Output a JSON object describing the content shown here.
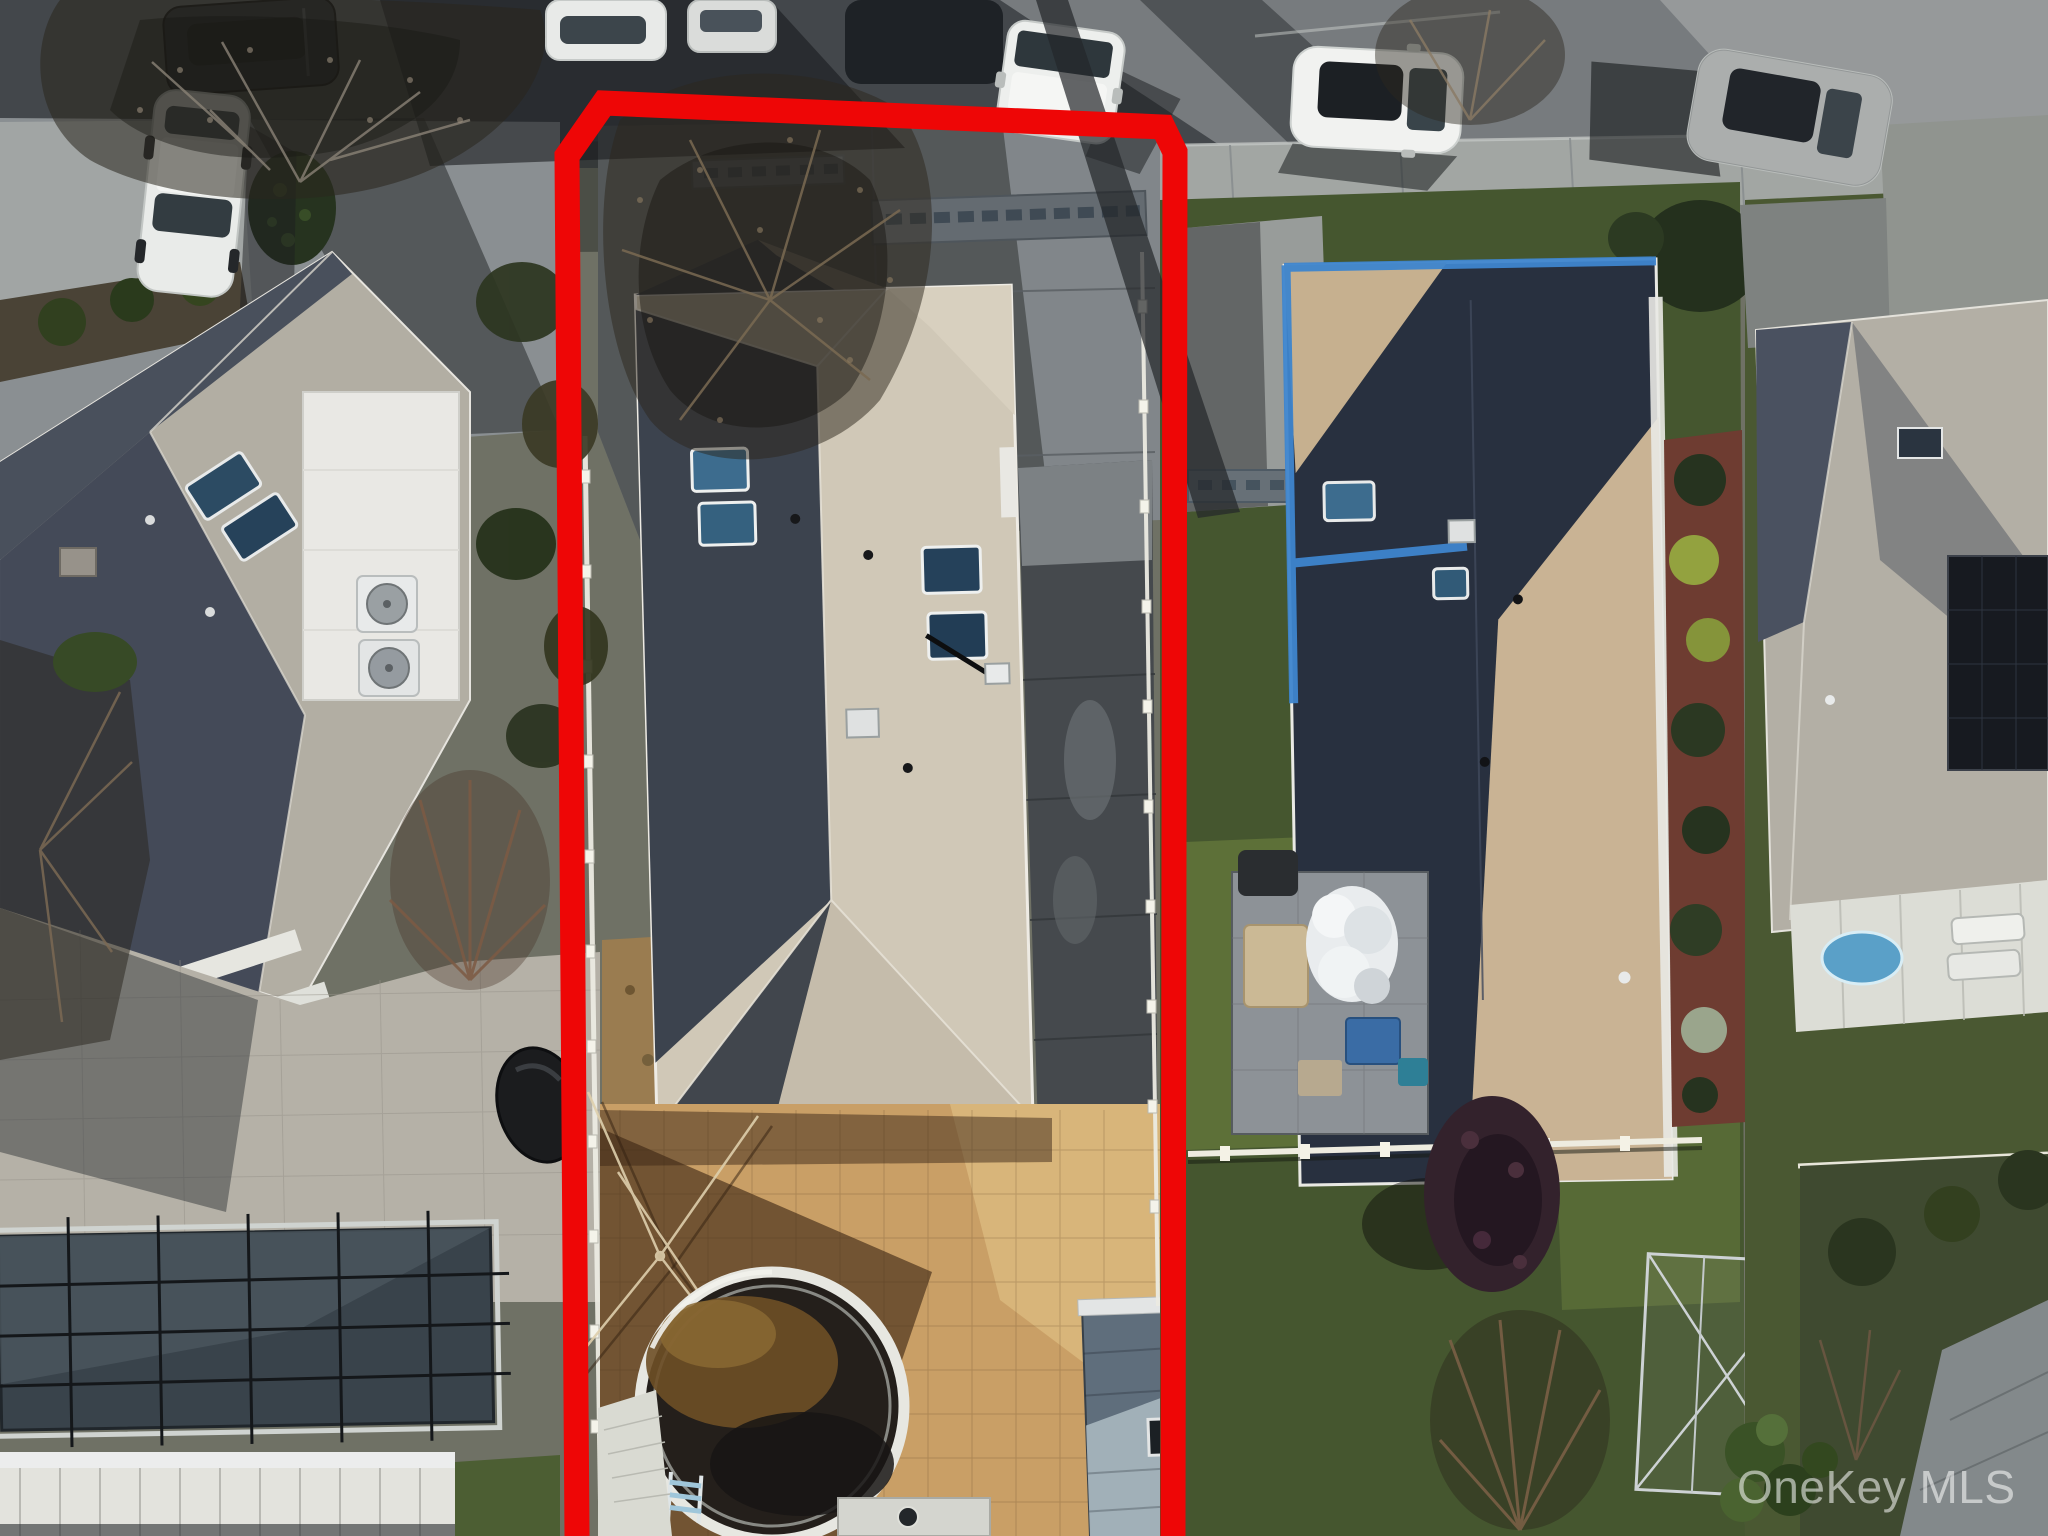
{
  "image": {
    "type": "aerial-drone-photograph",
    "description": "Top-down winter aerial view of three suburban residential lots with street at top; center lot highlighted with red boundary outline",
    "width_px": 2048,
    "height_px": 1536
  },
  "watermark": {
    "text": "OneKey MLS",
    "color": "#ffffff"
  },
  "annotations": {
    "property_boundary": {
      "color": "#ee0606",
      "shape": "open rectangle with beveled top corners, open at bottom edge",
      "highlighted_lot": "center property"
    }
  },
  "palette": {
    "asphalt": "#43474b",
    "asphalt_lit": "#797d80",
    "sidewalk": "#a2a6a3",
    "left_roof_lit": "#b2aea3",
    "left_roof_shadow": "#424957",
    "center_roof_lit": "#d0c8b7",
    "center_roof_shadow": "#3c434e",
    "right_roof_dark": "#28303f",
    "right_roof_lit": "#c9b394",
    "tarp_blue": "#3e85ce",
    "patio_tan": "#c99f66",
    "lawn_green": "#45562f",
    "pool_cover": "#39434b",
    "pool_water_dark": "#241f1b",
    "pool_water_amber": "#6e4f26",
    "fence_white": "#ecebe2",
    "mulch_red": "#6e3c31"
  },
  "scene": {
    "view": "top-down aerial of three suburban lots, low winter sun with long shadows",
    "street": {
      "position": "top edge",
      "parked_cars": [
        "dark sedan",
        "white sedan",
        "white compact",
        "dark car under tree",
        "white hatchback",
        "white suv",
        "white suv in shade"
      ]
    },
    "left_property": {
      "features": [
        "gray hip-roof house",
        "two skylights",
        "two ac units",
        "white flat-roof addition",
        "white car on concrete driveway",
        "paver patio",
        "covered rectangular in-ground pool",
        "white pergola",
        "black tarp-covered grill",
        "evergreen shrub",
        "bare trees"
      ]
    },
    "center_property": {
      "highlighted": true,
      "features": [
        "stamped concrete driveway",
        "overhanging bare tree",
        "tan shingle roof with front gable",
        "four skylights",
        "roof vents and antenna",
        "dark side walkway",
        "paver backyard",
        "clothesline frame",
        "oval above-ground pool with ladder",
        "white pool deck",
        "gray shed",
        "white boundary fences"
      ]
    },
    "right_property": {
      "features": [
        "brown shingle roof with blue tarp edges",
        "two skylights",
        "red mulch garden bed with shrubs",
        "rear paver patio",
        "tan seating",
        "white fluffy cover",
        "blue storage bins",
        "purple-leaf tree",
        "metal frame structure",
        "rear lawn",
        "white cross fence"
      ]
    },
    "far_right_property": {
      "features": [
        "gray hip roof",
        "rooftop solar panel",
        "dark skylight",
        "white rear porch",
        "blue kiddie pool",
        "white lounge chairs",
        "garden path",
        "hedges and shrubs"
      ]
    }
  }
}
